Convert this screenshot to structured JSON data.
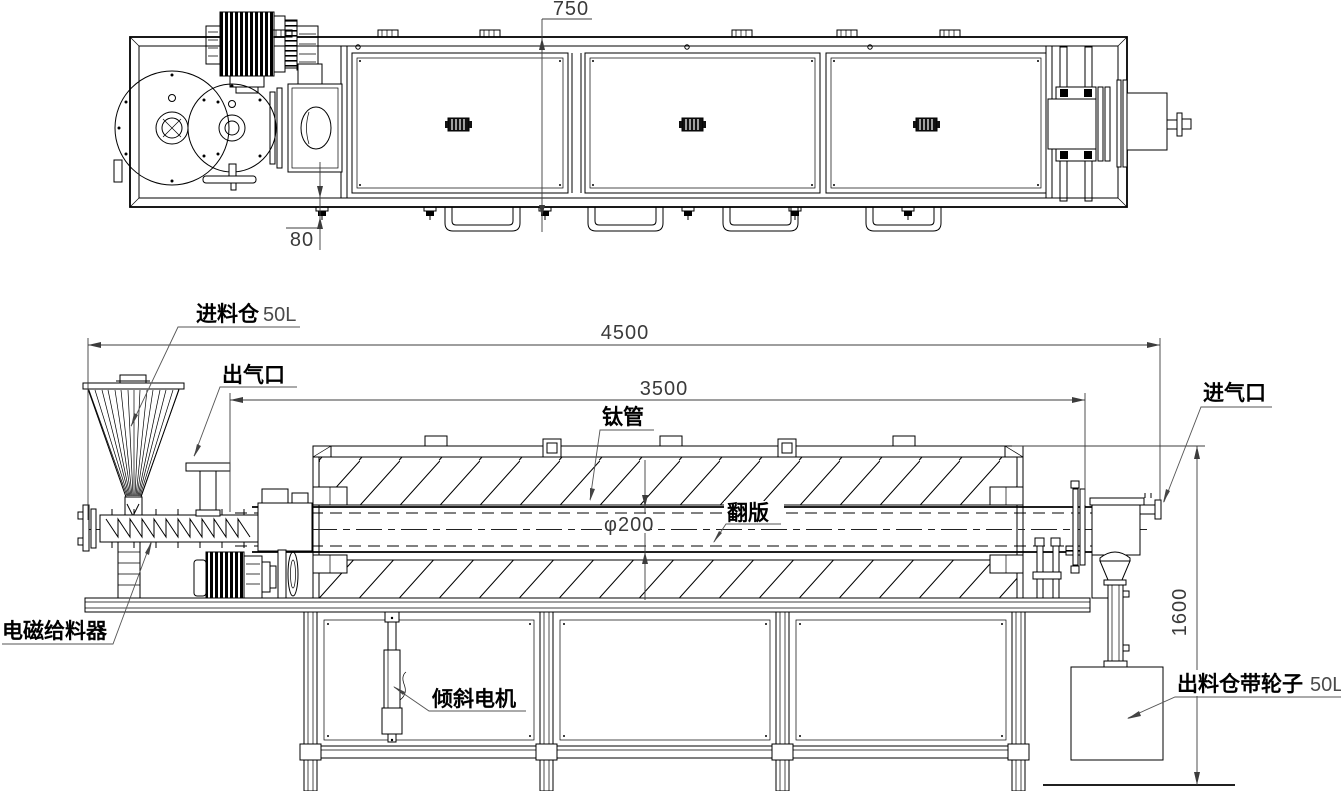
{
  "drawing": {
    "type": "engineering-drawing",
    "views": [
      "top-view",
      "side-view"
    ],
    "subject": "rotary tube furnace with feeder and discharge bin"
  },
  "labels": {
    "feed_hopper": "进料仓",
    "feed_hopper_cap": "50L",
    "gas_outlet": "出气口",
    "titanium_tube": "钛管",
    "flip_plate": "翻版",
    "gas_inlet": "进气口",
    "electromagnetic_feeder": "电磁给料器",
    "tilt_motor": "倾斜电机",
    "discharge_bin": "出料仓带轮子",
    "discharge_bin_cap": "50L"
  },
  "dimensions": {
    "top_view_width": "750",
    "top_view_offset": "80",
    "overall_length": "4500",
    "heated_length": "3500",
    "tube_diameter": "φ200",
    "discharge_height": "1600"
  },
  "colors": {
    "line": "#000000",
    "dimension_line": "#3c3c3c",
    "background": "#ffffff"
  }
}
